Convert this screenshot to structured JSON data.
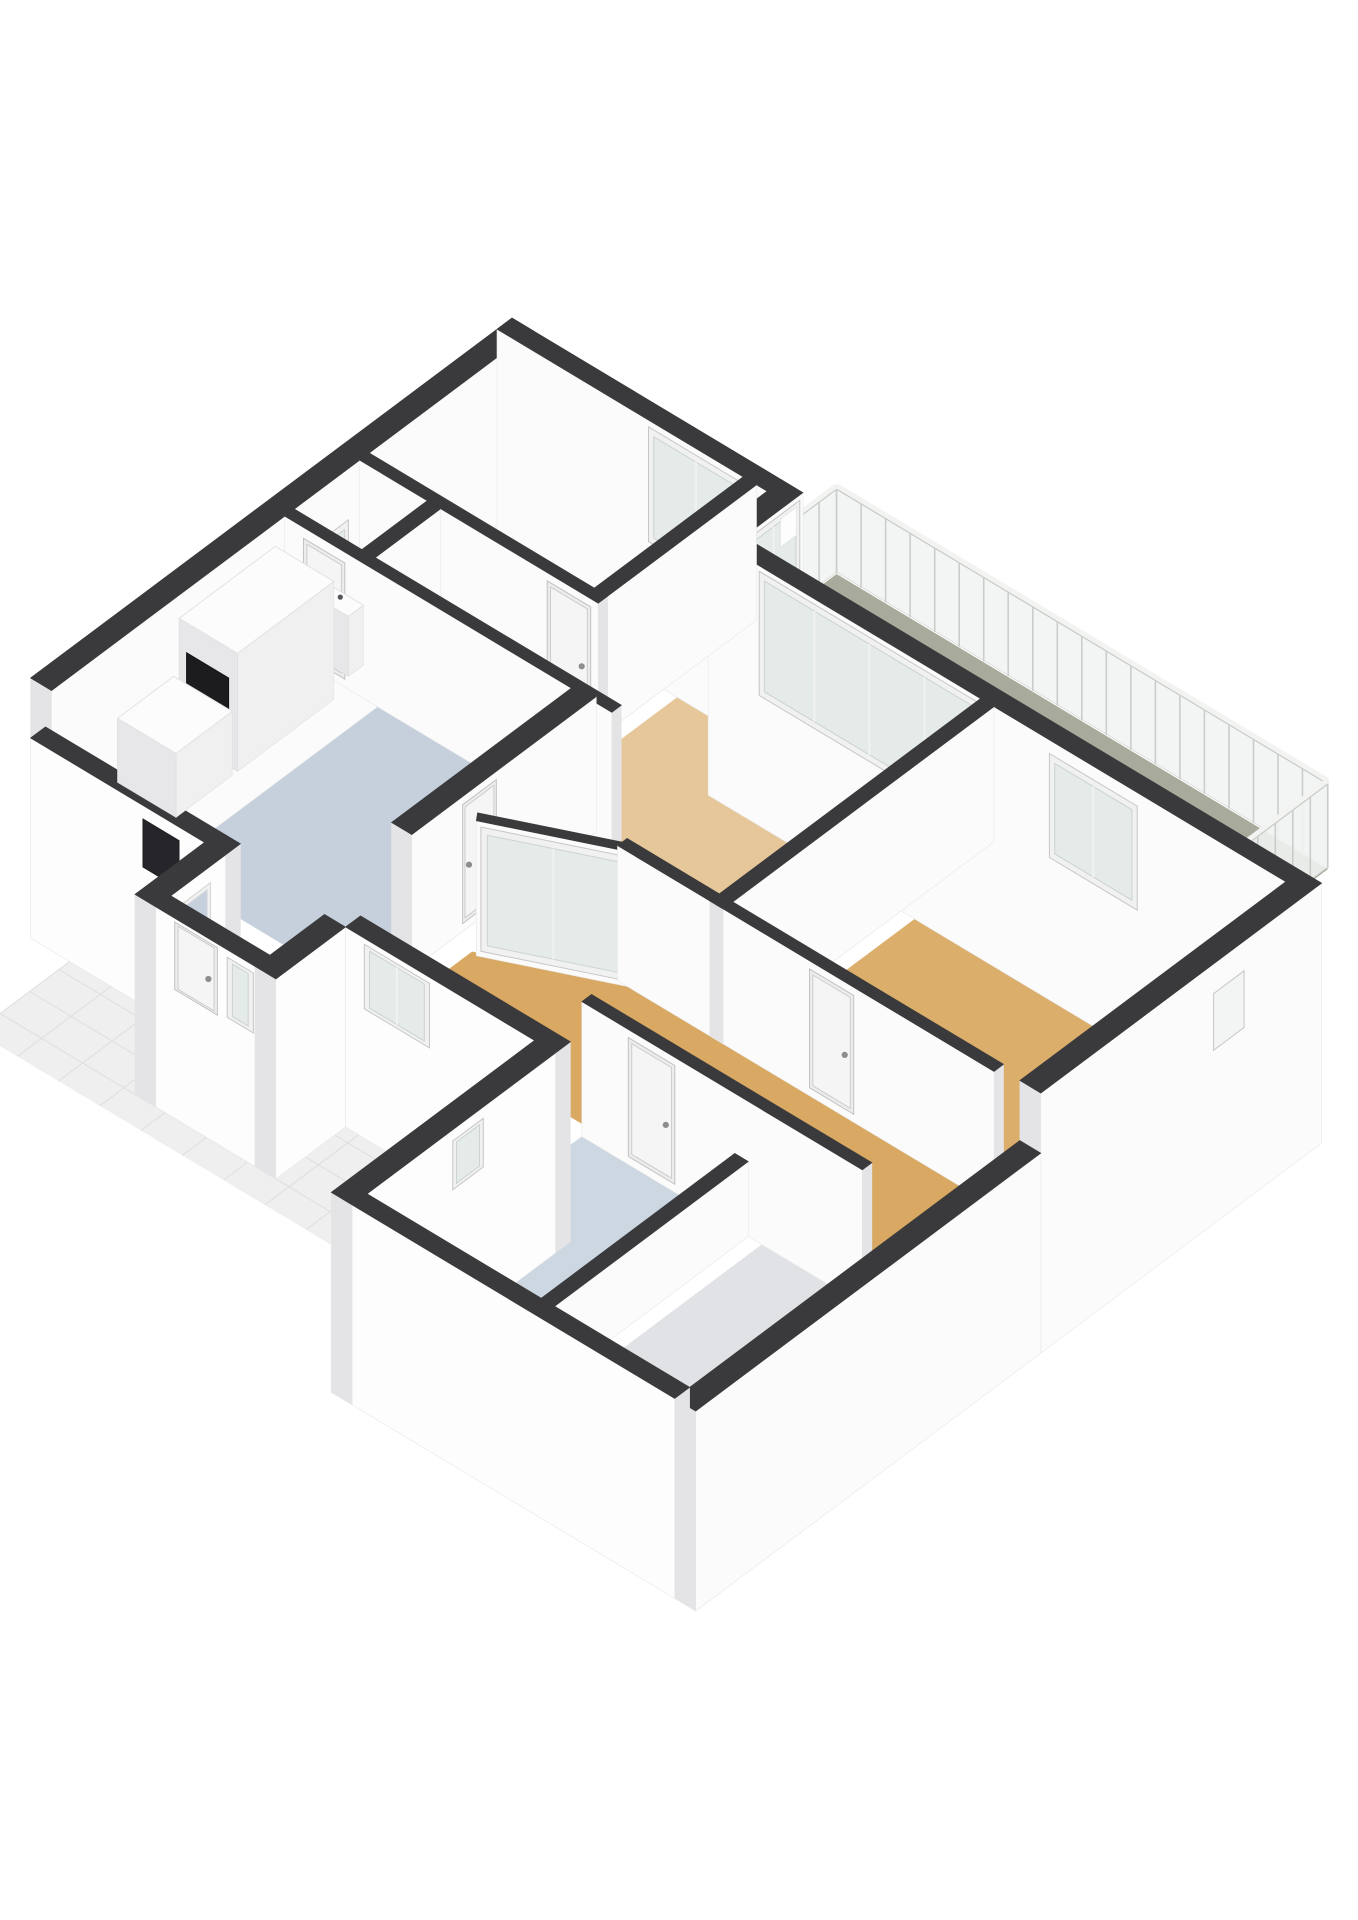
{
  "meta": {
    "kind": "3d-floorplan-render",
    "background": "#ffffff"
  },
  "palette": {
    "wall_top": "#3a3a3c",
    "wall_face": "#fbfbfb",
    "wall_face_shade": "#e9eaec",
    "wall_end": "#e4e4e6",
    "glass": "#e4ebe8",
    "glass_frame": "#f1f1f1",
    "door_leaf": "#f5f5f5",
    "handle": "#8d8d8d",
    "dark_opening": "#26262a",
    "railing_glass": "#f1f4f2",
    "railing_post": "#c9cecb"
  },
  "rooms": [
    {
      "id": "bedroom-1",
      "floor_color": "#dcba8c"
    },
    {
      "id": "closet",
      "floor_color": "#d9b88d"
    },
    {
      "id": "living-room",
      "floor_color": "#e5c79a"
    },
    {
      "id": "kitchen",
      "floor_color": "#c6d0dd"
    },
    {
      "id": "hall",
      "floor_color": "#d9a963"
    },
    {
      "id": "bedroom-2",
      "floor_color": "#dcae6c"
    },
    {
      "id": "bathroom",
      "floor_color": "#cdd7e2"
    },
    {
      "id": "storage",
      "floor_color": "#e0e2e5"
    },
    {
      "id": "vestibule",
      "floor_color": "#c6d0dd"
    },
    {
      "id": "balcony",
      "floor_color": "#a8ab9b"
    },
    {
      "id": "terrace",
      "floor_color": "#efefef"
    }
  ],
  "projection": {
    "ox": 512,
    "oy": 318,
    "e1": [
      75,
      45
    ],
    "e2": [
      -53.5,
      40
    ],
    "floor": 135,
    "low": 60,
    "base": 260,
    "rail": 47
  },
  "scene": {
    "balcony": {
      "floor": {
        "name": "balcony-floor",
        "color": "#a8ab9b",
        "pts": [
          [
            3.6,
            -1.02
          ],
          [
            10.15,
            -1.02
          ],
          [
            10.15,
            1.1
          ],
          [
            3.6,
            1.1
          ]
        ]
      },
      "rails": [
        {
          "name": "balcony-railing-left-return",
          "from": [
            3.6,
            -1.02
          ],
          "to": [
            3.6,
            0.0
          ]
        },
        {
          "name": "balcony-railing-front",
          "from": [
            3.6,
            -1.02
          ],
          "to": [
            10.15,
            -1.02
          ]
        },
        {
          "name": "balcony-railing-end",
          "from": [
            10.15,
            -1.02
          ],
          "to": [
            10.15,
            1.1
          ]
        }
      ]
    },
    "floors": [
      {
        "name": "floor-bedroom-1",
        "color": "#dcba8c",
        "pts": [
          [
            0.28,
            0.28
          ],
          [
            3.46,
            0.28
          ],
          [
            3.46,
            3.06
          ],
          [
            0.28,
            3.06
          ]
        ]
      },
      {
        "name": "floor-closet",
        "color": "#d9b88d",
        "pts": [
          [
            0.28,
            3.24
          ],
          [
            1.36,
            3.24
          ],
          [
            1.36,
            4.46
          ],
          [
            0.28,
            4.46
          ]
        ]
      },
      {
        "name": "floor-living-room",
        "color": "#e5c79a",
        "pts": [
          [
            3.64,
            1.38
          ],
          [
            7.32,
            1.38
          ],
          [
            7.32,
            6.26
          ],
          [
            6.0,
            6.26
          ],
          [
            4.64,
            7.06
          ],
          [
            4.64,
            4.46
          ],
          [
            1.54,
            4.46
          ],
          [
            1.54,
            3.24
          ],
          [
            3.64,
            3.24
          ]
        ]
      },
      {
        "name": "floor-kitchen",
        "color": "#c6d0dd",
        "pts": [
          [
            0.28,
            4.64
          ],
          [
            4.37,
            4.64
          ],
          [
            4.37,
            8.72
          ],
          [
            0.28,
            8.72
          ]
        ]
      },
      {
        "name": "floor-hall",
        "color": "#d9a963",
        "pts": [
          [
            6.09,
            6.44
          ],
          [
            11.02,
            6.44
          ],
          [
            11.02,
            8.72
          ],
          [
            4.37,
            8.72
          ],
          [
            4.37,
            8.0
          ],
          [
            4.64,
            8.0
          ],
          [
            4.64,
            7.25
          ]
        ]
      },
      {
        "name": "floor-bedroom-2",
        "color": "#dcae6c",
        "pts": [
          [
            7.59,
            1.38
          ],
          [
            11.02,
            1.38
          ],
          [
            11.02,
            6.26
          ],
          [
            7.59,
            6.26
          ]
        ]
      },
      {
        "name": "floor-bathroom",
        "color": "#cdd7e2",
        "pts": [
          [
            7.28,
            8.9
          ],
          [
            9.5,
            8.9
          ],
          [
            9.5,
            12.52
          ],
          [
            7.28,
            12.52
          ]
        ]
      },
      {
        "name": "floor-storage",
        "color": "#e0e2e5",
        "pts": [
          [
            9.68,
            8.9
          ],
          [
            11.02,
            8.9
          ],
          [
            11.02,
            12.52
          ],
          [
            9.68,
            12.52
          ]
        ]
      },
      {
        "name": "floor-vestibule",
        "color": "#c6d0dd",
        "pts": [
          [
            2.88,
            9.0
          ],
          [
            3.92,
            9.0
          ],
          [
            3.92,
            10.02
          ],
          [
            2.88,
            10.02
          ]
        ]
      }
    ],
    "terrace": {
      "name": "terrace-tiles",
      "color": "#efefef",
      "line": "#dedede",
      "step": 0.55,
      "rects": [
        [
          1.7,
          10.3,
          7.0,
          12.4
        ],
        [
          1.7,
          9.0,
          2.6,
          10.3
        ],
        [
          4.2,
          9.0,
          7.0,
          10.3
        ]
      ]
    },
    "walls": [
      {
        "name": "wall-nw-facade",
        "from": [
          0,
          0
        ],
        "to": [
          0,
          9.0
        ],
        "t": -0.28,
        "h": "tall",
        "ext": true,
        "decals": [
          {
            "kind": "glass",
            "u0": 3.45,
            "u1": 4.18,
            "z0": 0.28,
            "z1": 0.62,
            "mull": 0
          }
        ]
      },
      {
        "name": "wall-ne-bedroom1",
        "from": [
          0,
          0
        ],
        "to": [
          3.6,
          0
        ],
        "t": 0.28,
        "h": "tall",
        "ext": true,
        "decals": [
          {
            "kind": "glass",
            "u0": 2.02,
            "u1": 3.28,
            "z0": 0.1,
            "z1": 0.95,
            "mull": 1
          }
        ]
      },
      {
        "name": "wall-balcony-step",
        "from": [
          3.6,
          0
        ],
        "to": [
          3.6,
          1.1
        ],
        "t": -0.28,
        "h": "tall",
        "ext": true,
        "decals": [
          {
            "kind": "glass",
            "u0": 0.06,
            "u1": 1.04,
            "z0": 0.05,
            "z1": 0.96,
            "mull": 1
          },
          {
            "kind": "panel",
            "u0": 0.12,
            "u1": 0.42,
            "z0": 0.72,
            "z1": 0.93,
            "fill": "#fdfdfd"
          }
        ]
      },
      {
        "name": "wall-ne-living",
        "from": [
          3.6,
          1.1
        ],
        "to": [
          11.3,
          1.1
        ],
        "t": 0.28,
        "h": "tall",
        "ext": true,
        "decals": [
          {
            "kind": "glass",
            "u0": 0.68,
            "u1": 3.62,
            "z0": 0.04,
            "z1": 0.96,
            "mull": 3
          },
          {
            "kind": "glass",
            "u0": 4.55,
            "u1": 5.72,
            "z0": 0.13,
            "z1": 0.9,
            "mull": 1
          }
        ]
      },
      {
        "name": "wall-bedroom1-east",
        "from": [
          3.46,
          0.28
        ],
        "to": [
          3.46,
          3.24
        ],
        "t": 0.18,
        "h": "tall",
        "ext": false,
        "decals": []
      },
      {
        "name": "wall-bedroom1-south",
        "from": [
          0.28,
          3.06
        ],
        "to": [
          3.46,
          3.06
        ],
        "t": 0.18,
        "h": "tall",
        "ext": false,
        "decals": [
          {
            "kind": "door",
            "u0": 2.5,
            "u1": 3.08,
            "z0": 0.06,
            "z1": 0.94
          }
        ]
      },
      {
        "name": "wall-closet-east",
        "from": [
          1.36,
          3.24
        ],
        "to": [
          1.36,
          4.46
        ],
        "t": 0.18,
        "h": "tall",
        "ext": false,
        "decals": []
      },
      {
        "name": "wall-kitchen-north",
        "from": [
          0.28,
          4.46
        ],
        "to": [
          4.64,
          4.46
        ],
        "t": 0.18,
        "h": "tall",
        "ext": false,
        "decals": [
          {
            "kind": "door",
            "u0": 0.25,
            "u1": 0.8,
            "z0": 0.06,
            "z1": 0.92
          }
        ]
      },
      {
        "name": "wall-kitchen-living",
        "from": [
          4.37,
          4.55
        ],
        "to": [
          4.37,
          8.0
        ],
        "t": 0.27,
        "h": "tall",
        "ext": false,
        "decals": [
          {
            "kind": "door",
            "u0": 1.87,
            "u1": 2.5,
            "z0": 0.06,
            "z1": 0.94
          }
        ]
      },
      {
        "name": "wall-hall-glazing",
        "from": [
          4.64,
          7.15
        ],
        "to": [
          6.09,
          6.3
        ],
        "t": 0.14,
        "h": "tall",
        "ext": false,
        "decals": [
          {
            "kind": "glass",
            "u0": 0.05,
            "u1": 1.63,
            "z0": 0.04,
            "z1": 0.96,
            "mull": 1
          }
        ]
      },
      {
        "name": "wall-living-hall",
        "from": [
          6.0,
          6.26
        ],
        "to": [
          7.41,
          6.26
        ],
        "t": 0.18,
        "h": "tall",
        "ext": false,
        "decals": []
      },
      {
        "name": "wall-bedroom2-west",
        "from": [
          7.41,
          1.38
        ],
        "to": [
          7.41,
          6.44
        ],
        "t": 0.18,
        "h": "tall",
        "ext": false,
        "decals": []
      },
      {
        "name": "wall-bedroom2-south",
        "from": [
          7.41,
          6.26
        ],
        "to": [
          11.02,
          6.26
        ],
        "t": 0.18,
        "h": "tall",
        "ext": false,
        "decals": [
          {
            "kind": "door",
            "u0": 1.15,
            "u1": 1.74,
            "z0": 0.06,
            "z1": 0.94
          }
        ]
      },
      {
        "name": "wall-se-facade-upper",
        "from": [
          11.3,
          1.1
        ],
        "to": [
          11.3,
          6.35
        ],
        "t": -0.28,
        "h": "tall",
        "ext": true,
        "decals": [
          {
            "kind": "glass",
            "u0": 1.45,
            "u1": 2.02,
            "z0": 0.36,
            "z1": 0.78,
            "mull": 0,
            "fill": "#f3f4f4"
          }
        ]
      },
      {
        "name": "wall-wing-north",
        "from": [
          7.28,
          8.72
        ],
        "to": [
          11.02,
          8.72
        ],
        "t": 0.18,
        "h": "tall",
        "ext": false,
        "decals": [
          {
            "kind": "door",
            "u0": 0.62,
            "u1": 1.24,
            "z0": 0.06,
            "z1": 0.94
          }
        ]
      },
      {
        "name": "wall-wing-divider",
        "from": [
          9.5,
          8.9
        ],
        "to": [
          9.5,
          12.52
        ],
        "t": 0.18,
        "h": "low",
        "ext": false,
        "decals": []
      },
      {
        "name": "wall-sw-facade-west",
        "from": [
          0,
          9.0
        ],
        "to": [
          2.6,
          9.0
        ],
        "t": -0.28,
        "h": "low",
        "ext": true,
        "decals": [
          {
            "kind": "dark",
            "u0": 1.5,
            "u1": 1.98,
            "z0": 0.18,
            "z1": 0.82
          }
        ]
      },
      {
        "name": "wall-vestibule-west",
        "from": [
          2.6,
          9.0
        ],
        "to": [
          2.6,
          10.3
        ],
        "t": 0.28,
        "h": "low",
        "ext": true,
        "decals": [
          {
            "kind": "hole",
            "u0": 0.28,
            "u1": 0.92,
            "z0": 0.22,
            "z1": 0.78,
            "fill": "#c6d0dd"
          }
        ]
      },
      {
        "name": "wall-vestibule-south",
        "from": [
          2.6,
          10.3
        ],
        "to": [
          4.2,
          10.3
        ],
        "t": -0.28,
        "h": "low",
        "ext": true,
        "decals": [
          {
            "kind": "door",
            "u0": 0.25,
            "u1": 0.82,
            "z0": 0.05,
            "z1": 0.95
          },
          {
            "kind": "glass",
            "u0": 0.95,
            "u1": 1.3,
            "z0": 0.1,
            "z1": 0.9,
            "mull": 0
          }
        ]
      },
      {
        "name": "wall-vestibule-east",
        "from": [
          4.2,
          10.3
        ],
        "to": [
          4.2,
          9.0
        ],
        "t": -0.28,
        "h": "low",
        "ext": true,
        "decals": []
      },
      {
        "name": "wall-sw-facade-mid",
        "from": [
          4.2,
          9.0
        ],
        "to": [
          7.0,
          9.0
        ],
        "t": -0.28,
        "h": "low",
        "ext": true,
        "decals": [
          {
            "kind": "glass",
            "u0": 0.25,
            "u1": 1.12,
            "z0": 0.06,
            "z1": 0.92,
            "mull": 1
          }
        ]
      },
      {
        "name": "wall-wing-nw",
        "from": [
          7.0,
          9.0
        ],
        "to": [
          7.0,
          12.8
        ],
        "t": 0.28,
        "h": "low",
        "ext": true,
        "decals": [
          {
            "kind": "glass",
            "u0": 1.35,
            "u1": 1.92,
            "z0": 0.2,
            "z1": 0.85,
            "mull": 0
          }
        ]
      },
      {
        "name": "wall-se-facade-lower",
        "from": [
          11.3,
          6.35
        ],
        "to": [
          11.3,
          12.8
        ],
        "t": -0.28,
        "h": "low",
        "ext": true,
        "decals": []
      },
      {
        "name": "wall-wing-south",
        "from": [
          7.0,
          12.8
        ],
        "to": [
          11.3,
          12.8
        ],
        "t": -0.28,
        "h": "low",
        "ext": true,
        "decals": []
      }
    ],
    "boxes": [
      {
        "name": "closet-sink",
        "a0": 0.5,
        "b0": 4.18,
        "a1": 1.0,
        "b1": 4.46,
        "h": 60,
        "tap": true
      },
      {
        "name": "kitchen-tall-cabinet",
        "a0": 0.34,
        "b0": 4.9,
        "a1": 1.12,
        "b1": 6.7,
        "h": 118,
        "decal": {
          "u0": 0.1,
          "u1": 0.66,
          "zpx0": 28,
          "zpx1": 88,
          "fill": "#1c1c1e"
        }
      },
      {
        "name": "kitchen-counter",
        "a0": 0.34,
        "b0": 6.8,
        "a1": 1.12,
        "b1": 7.85,
        "h": 64
      }
    ]
  }
}
